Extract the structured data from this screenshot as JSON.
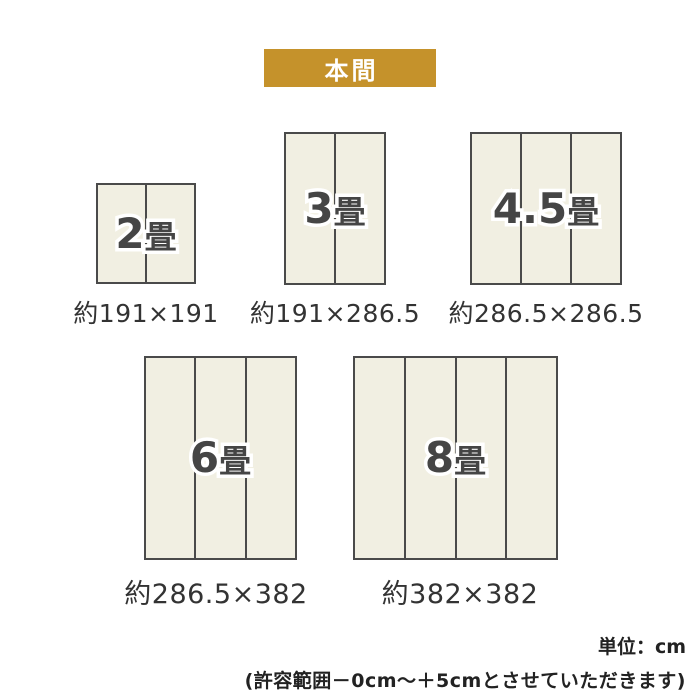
{
  "banner": {
    "label": "本間",
    "bg_color": "#C5922B",
    "text_color": "#FFFFFF"
  },
  "mats": [
    {
      "name": "2jo",
      "num": "2",
      "unit": "畳",
      "size_label": "約191×191",
      "width_cm": "191",
      "height_cm": "191",
      "panels": 2
    },
    {
      "name": "3jo",
      "num": "3",
      "unit": "畳",
      "size_label": "約191×286.5",
      "width_cm": "191",
      "height_cm": "286.5",
      "panels": 2
    },
    {
      "name": "4_5jo",
      "num": "4.5",
      "unit": "畳",
      "size_label": "約286.5×286.5",
      "width_cm": "286.5",
      "height_cm": "286.5",
      "panels": 3
    },
    {
      "name": "6jo",
      "num": "6",
      "unit": "畳",
      "size_label": "約286.5×382",
      "width_cm": "286.5",
      "height_cm": "382",
      "panels": 3
    },
    {
      "name": "8jo",
      "num": "8",
      "unit": "畳",
      "size_label": "約382×382",
      "width_cm": "382",
      "height_cm": "382",
      "panels": 4
    }
  ],
  "footnote": {
    "unit_label": "単位：cm",
    "tolerance_note": "(許容範囲－0cm～＋5cmとさせていただきます)"
  },
  "colors": {
    "accent_gold": "#C5922B",
    "mat_fill": "#F1EFE2",
    "mat_border": "#4A4A4A",
    "label_text": "#454545",
    "caption_text": "#333333",
    "outline_white": "#FFFFFF"
  }
}
